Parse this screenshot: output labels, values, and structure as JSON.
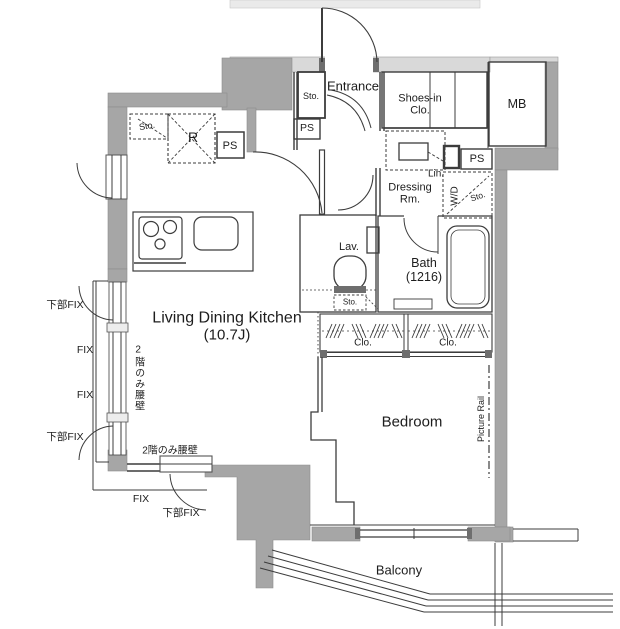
{
  "floorplan": {
    "unit_labels": {
      "entrance": "Entrance",
      "shoes_in_closet_line1": "Shoes-in",
      "shoes_in_closet_line2": "Clo.",
      "meter_box": "MB",
      "storage_entrance": "Sto.",
      "pipe_space_entrance": "PS",
      "linen": "Lin.",
      "pipe_space_right": "PS",
      "dressing_room_line1": "Dressing",
      "dressing_room_line2": "Rm.",
      "washer_dryer": "W/D",
      "storage_wd": "Sto.",
      "storage_kitchen": "Sto.",
      "refrigerator": "R",
      "pipe_space_kitchen": "PS",
      "lavatory": "Lav.",
      "storage_lavatory": "Sto.",
      "bath_line1": "Bath",
      "bath_line2": "(1216)",
      "ldk_line1": "Living Dining Kitchen",
      "ldk_line2": "(10.7J)",
      "closet_left": "Clo.",
      "closet_right": "Clo.",
      "bedroom": "Bedroom",
      "picture_rail": "Picture Rail",
      "balcony": "Balcony",
      "waist_wall_vertical": "2階のみ腰壁",
      "waist_wall_horizontal": "2階のみ腰壁",
      "window_labels": [
        "下部FIX",
        "FIX",
        "FIX",
        "下部FIX",
        "FIX",
        "下部FIX"
      ]
    },
    "colors": {
      "wall": "#a6a6a6",
      "wall_light": "#d9d9d9",
      "line": "#3c3c3c",
      "background": "#ffffff"
    }
  }
}
